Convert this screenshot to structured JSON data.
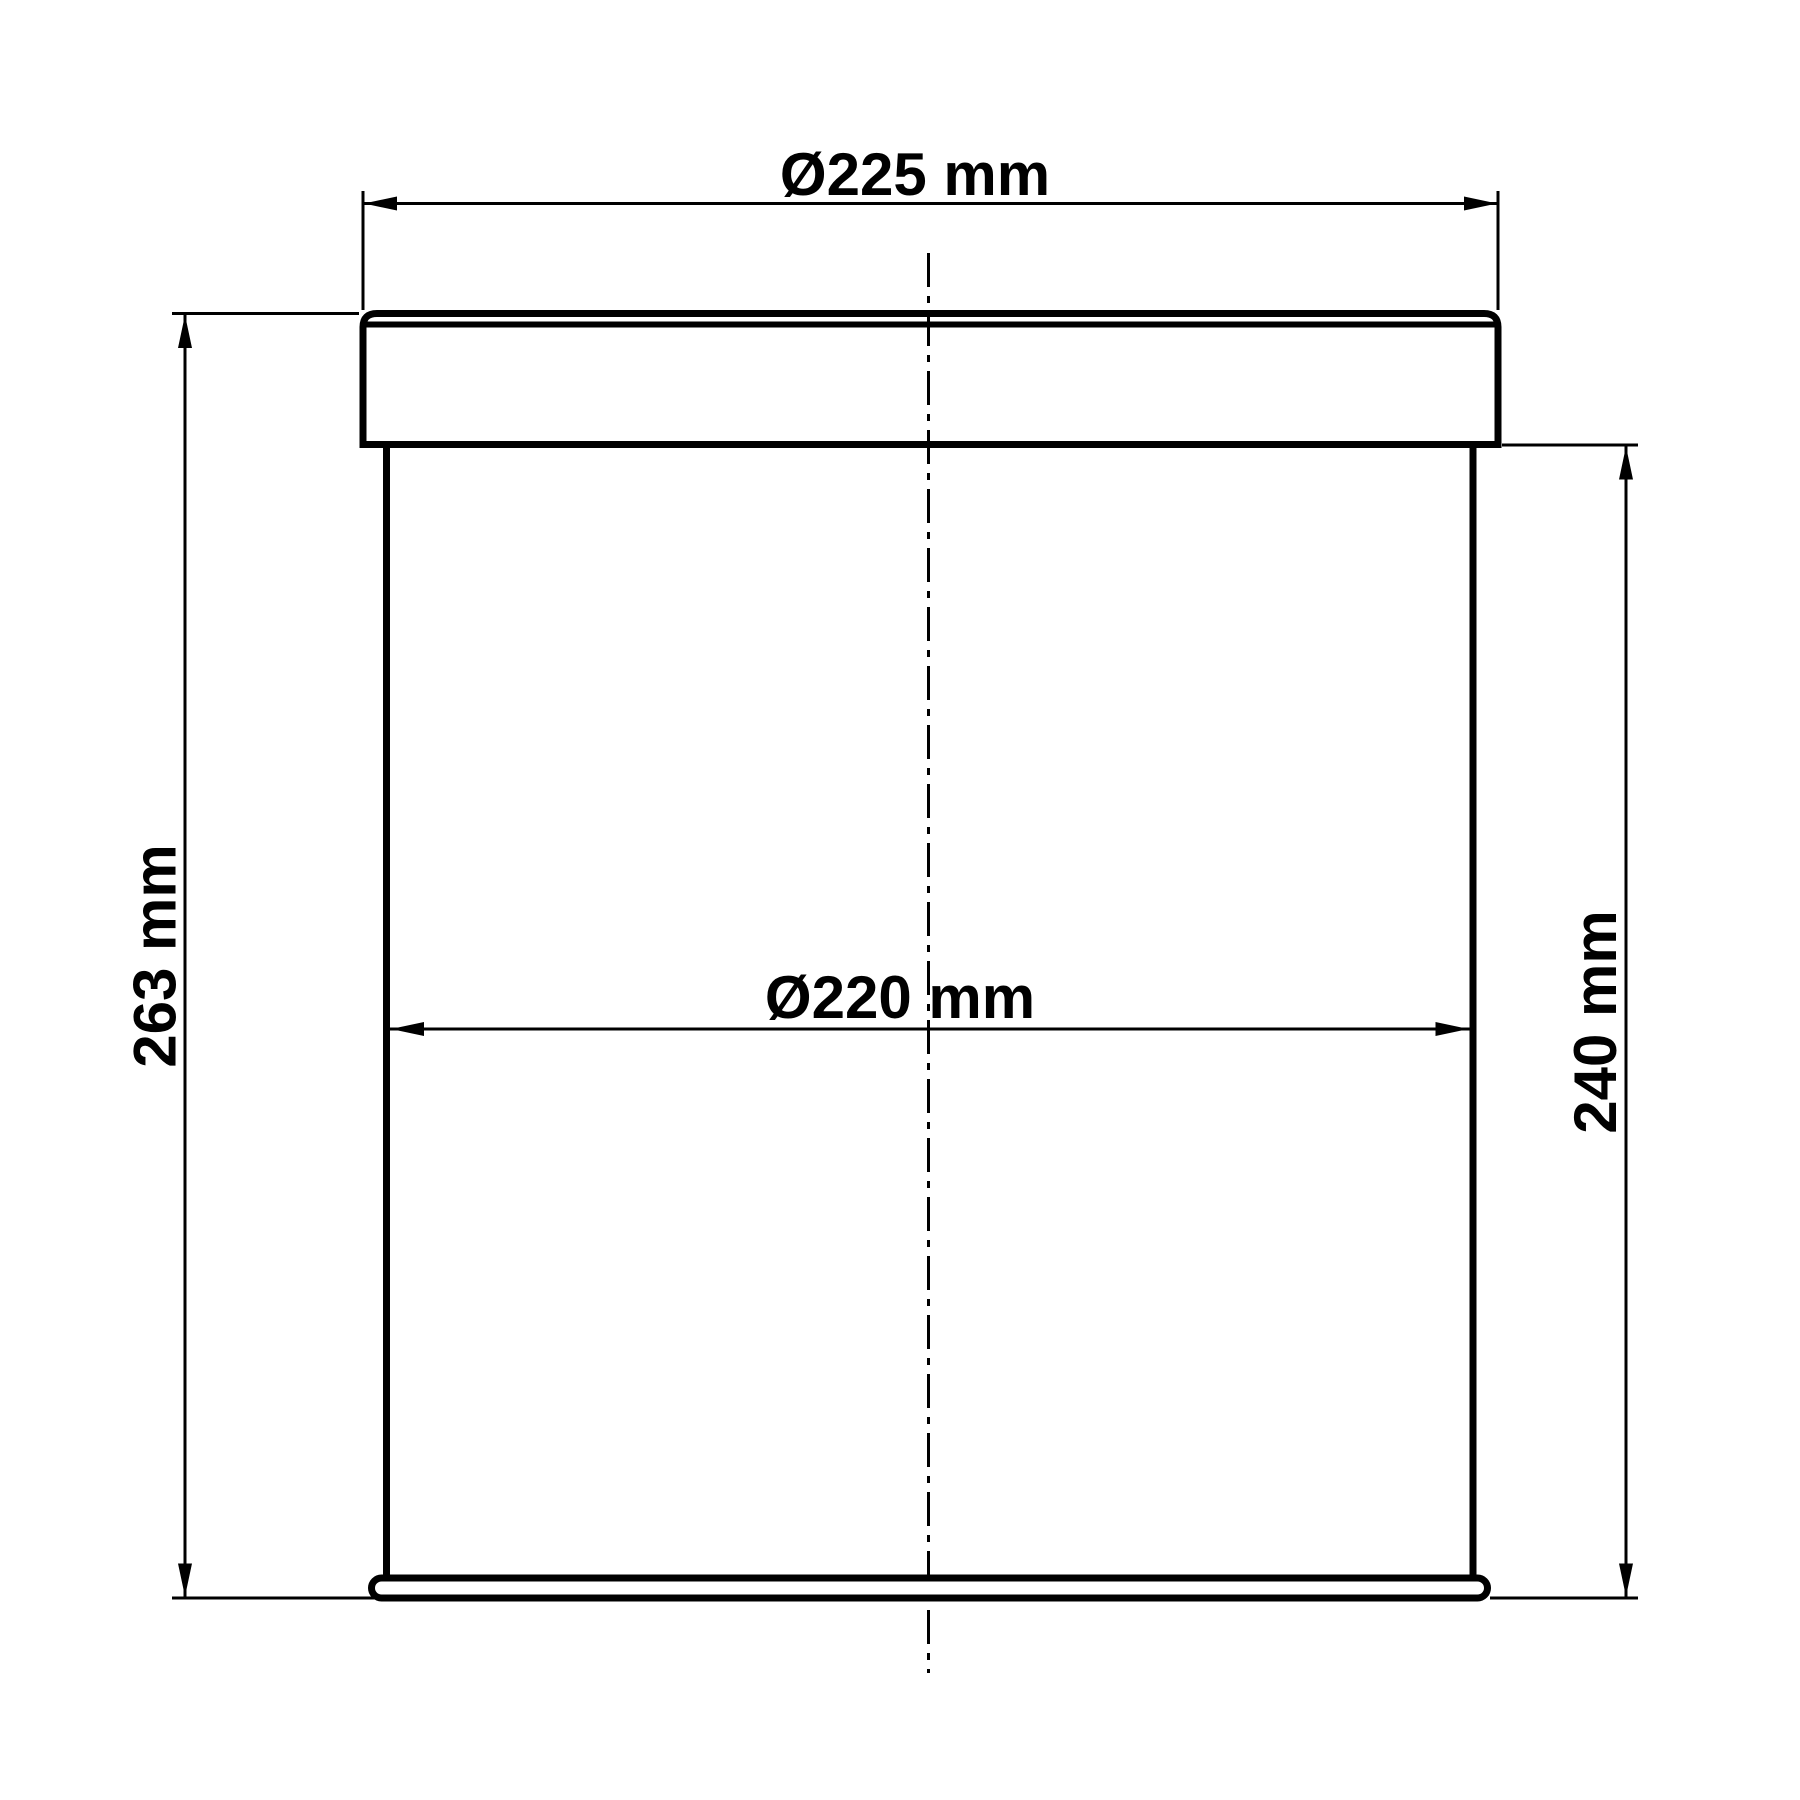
{
  "drawing": {
    "background_color": "#ffffff",
    "line_color": "#000000",
    "labels": {
      "lid_diameter": "Ø225 mm",
      "inner_diameter": "Ø220 mm",
      "overall_height": "263 mm",
      "body_height": "240 mm"
    }
  }
}
